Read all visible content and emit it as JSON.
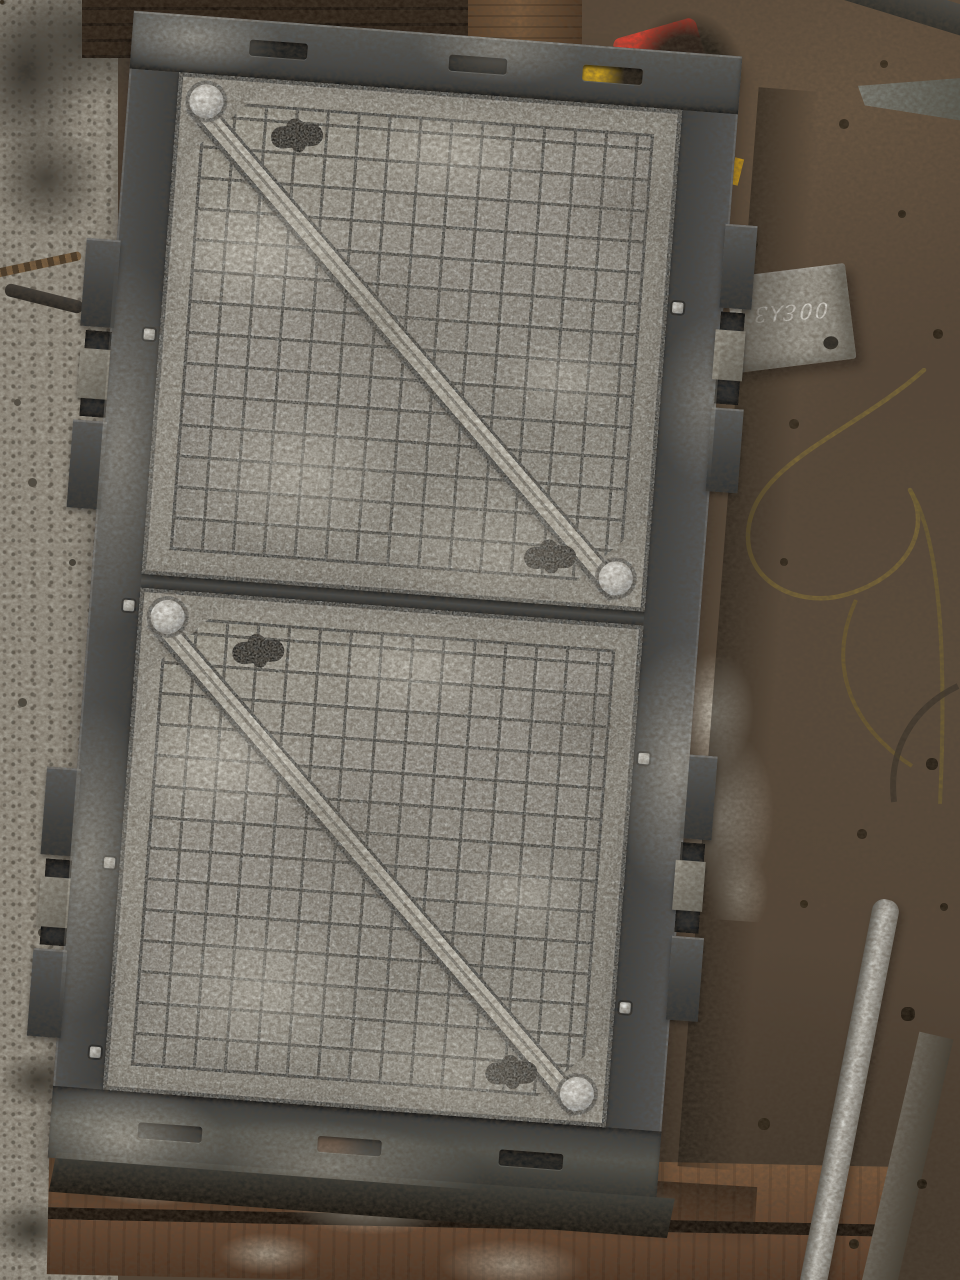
{
  "scene": {
    "type": "photograph",
    "subject": "Two square cast-iron grated manhole covers set in one rectangular cast-iron frame, lying on a workshop floor",
    "setting": "factory floor: light concrete strip at left, packed brown dirt at right, wooden planks under the bottom edge"
  },
  "marking": {
    "text": "00Ɛ⅄3"
  },
  "objects": {
    "assembly": "double manhole cover with frame",
    "panel": "square grated cover with diagonal rib, corner bolts and keyhole lifting slots",
    "frame": "castellated cast-iron frame with side lugs and vent slots",
    "metal_block": "grey metal block with handwritten chalk marking",
    "pipe": "steel pipe on floor",
    "wire": "looped brass wire on dirt floor",
    "marker_object": "yellow and red object near top edge",
    "planks": "paint-splattered wooden planks"
  },
  "colors": {
    "iron_dark": "#3f4244",
    "iron_highlight": "#bcb9ae",
    "panel_grey": "#8b8881",
    "dirt_brown": "#5c4c3e",
    "concrete_grey": "#a19c90",
    "wood_plank": "#7d5a3d",
    "marker_yellow": "#e3b524",
    "marker_red": "#cf3527",
    "bolt_silver": "#dcdcd6"
  }
}
